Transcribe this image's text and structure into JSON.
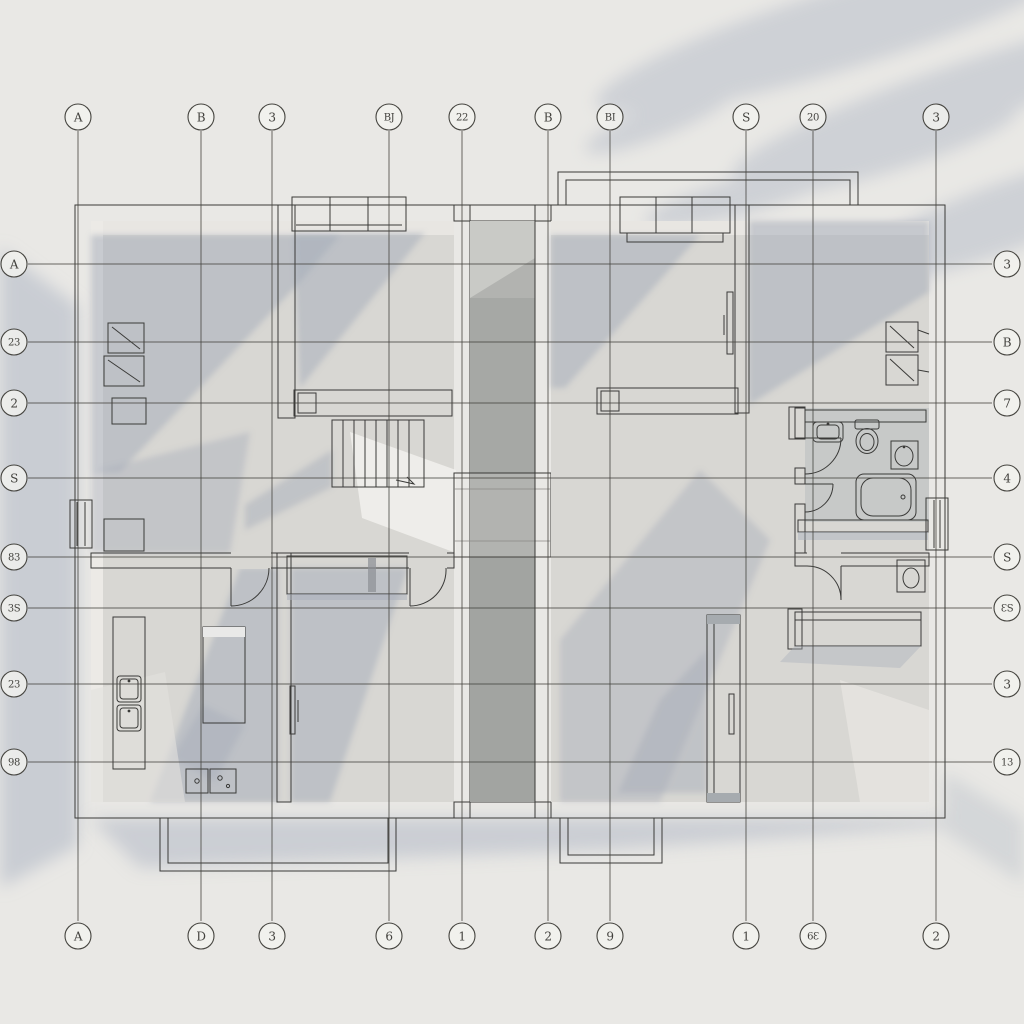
{
  "drawing": {
    "type": "architectural-floor-plan",
    "view": "axonometric-top-down-two-unit-apartment-plan",
    "grid": {
      "columns": [
        {
          "x": 78,
          "top": "A",
          "bottom": "A"
        },
        {
          "x": 201,
          "top": "B",
          "bottom": "D"
        },
        {
          "x": 272,
          "top": "3",
          "bottom": "3"
        },
        {
          "x": 389,
          "top": "BJ",
          "bottom": "6"
        },
        {
          "x": 462,
          "top": "22",
          "bottom": "1"
        },
        {
          "x": 548,
          "top": "B",
          "bottom": "2"
        },
        {
          "x": 610,
          "top": "BI",
          "bottom": "9"
        },
        {
          "x": 746,
          "top": "S",
          "bottom": "1"
        },
        {
          "x": 813,
          "top": "20",
          "bottom": "6Ɛ"
        },
        {
          "x": 936,
          "top": "3",
          "bottom": "2"
        }
      ],
      "rows": [
        {
          "y": 264,
          "left": "A",
          "right": "3"
        },
        {
          "y": 342,
          "left": "23",
          "right": "B"
        },
        {
          "y": 403,
          "left": "2",
          "right": "7"
        },
        {
          "y": 478,
          "left": "S",
          "right": "4"
        },
        {
          "y": 557,
          "left": "83",
          "right": "S"
        },
        {
          "y": 608,
          "left": "3S",
          "right": "ƐS"
        },
        {
          "y": 684,
          "left": "23",
          "right": "3"
        },
        {
          "y": 762,
          "left": "98",
          "right": "13"
        }
      ]
    },
    "colors": {
      "paper": "#e9e8e5",
      "shadow": "#a7aebb",
      "wall": "#f6f5f2",
      "floor": "#d8d7d3",
      "corridor": "#b2b3b0",
      "line": "#45443f",
      "outline": "#3a3a38"
    },
    "fixtures": {
      "left_unit": [
        "window",
        "wall-shelves",
        "bed-ledge",
        "stairs",
        "wardrobe-cabinet",
        "swing-doors",
        "kitchen-counter",
        "kitchen-sinks",
        "kitchen-island",
        "cooktop",
        "sliding-door",
        "side-window",
        "terrace"
      ],
      "right_unit": [
        "balcony",
        "window",
        "bed-ledge",
        "wall-cabinets",
        "vanity-counter",
        "sink",
        "toilet",
        "washbasin",
        "bathtub",
        "wc-basin",
        "lower-counter",
        "wardrobe-panel",
        "side-window",
        "terrace"
      ]
    }
  }
}
